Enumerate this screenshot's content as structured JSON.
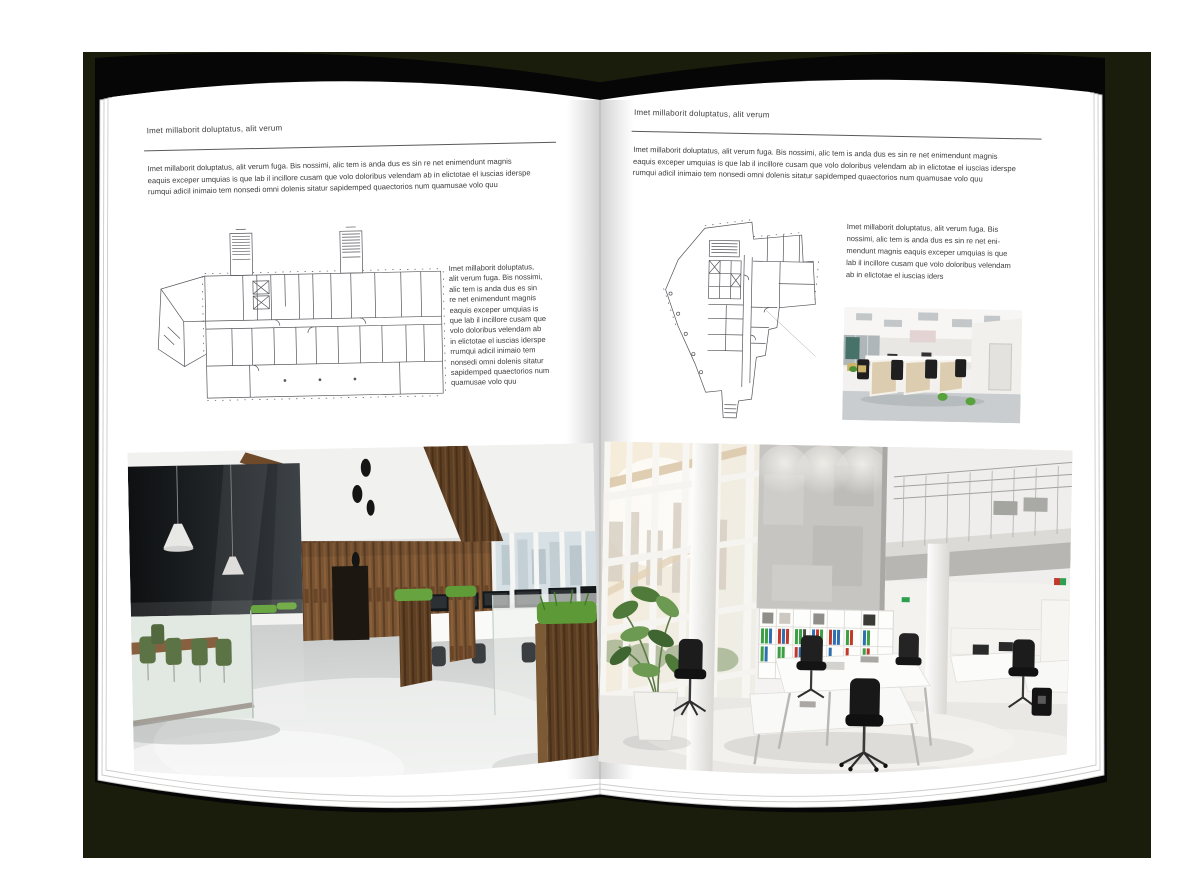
{
  "palette": {
    "backdrop": "#1b1d0c",
    "cover": "#060606",
    "page": "#ffffff",
    "text": "#3c3c3c",
    "rule_line": "#5a5a5e",
    "plan_line": "#54555a",
    "wood": "#7a5433",
    "grass_green": "#5f9c38",
    "binder_green": "#3c9e45",
    "binder_red": "#c0392b",
    "binder_blue": "#2e6fb0"
  },
  "left_page": {
    "kicker": "Imet millaborit doluptatus, alit verum",
    "intro": "Imet millaborit doluptatus, alit verum fuga. Bis nossimi, alic tem is anda dus es sin re net enimendunt magnis\neaquis exceper umquias is que lab il incillore cusam que volo doloribus velendam ab in elictotae el iuscias iderspe\nrumqui adicil inimaio tem nonsedi omni dolenis sitatur sapidemped quaectorios num quamusae volo quu",
    "side_text": "Imet millaborit doluptatus,\nalit verum fuga. Bis nossimi,\nalic tem is anda dus es sin\nre net enimendunt magnis\neaquis exceper umquias is\nque lab il incillore cusam que\nvolo doloribus velendam ab\nin elictotae el iuscias iderspe\nrrumqui adicil inimaio tem\nnonsedi omni dolenis sitatur\nsapidemped quaectorios num\nquamusae volo quu"
  },
  "right_page": {
    "kicker": "Imet millaborit doluptatus, alit verum",
    "intro": "Imet millaborit doluptatus, alit verum fuga. Bis nossimi, alic tem is anda dus es sin re net enimendunt magnis\neaquis exceper umquias is que lab il incillore cusam que volo doloribus velendam ab in elictotae el iuscias iderspe\nrumqui adicil inimaio tem nonsedi omni dolenis sitatur sapidemped quaectorios num quamusae volo quu",
    "side_text": "Imet millaborit doluptatus, alit verum fuga. Bis\nnossimi, alic tem is anda dus es sin re net eni-\nmendunt magnis eaquis exceper umquias is que\nlab il incillore cusam que volo doloribus velendam\nab in elictotae el iuscias iders"
  }
}
